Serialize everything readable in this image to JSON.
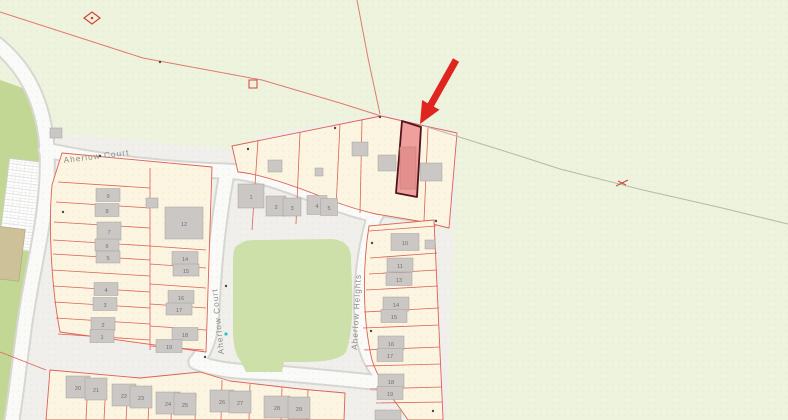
{
  "map": {
    "streets": {
      "aherlow_court_top": "Aherlow Court",
      "aherlow_court_side": "Aherlow Court",
      "aherlow_heights": "Aherlow Heights"
    },
    "plot_numbers": {
      "west_column": [
        {
          "n": "9",
          "x": 108,
          "y": 198,
          "w": 24,
          "h": 13
        },
        {
          "n": "8",
          "x": 107,
          "y": 213,
          "w": 24,
          "h": 13
        },
        {
          "n": "7",
          "x": 109,
          "y": 234,
          "w": 24,
          "h": 18
        },
        {
          "n": "6",
          "x": 107,
          "y": 248,
          "w": 24,
          "h": 12
        },
        {
          "n": "5",
          "x": 108,
          "y": 260,
          "w": 24,
          "h": 12
        },
        {
          "n": "4",
          "x": 106,
          "y": 292,
          "w": 24,
          "h": 13
        },
        {
          "n": "3",
          "x": 105,
          "y": 307,
          "w": 24,
          "h": 13
        },
        {
          "n": "2",
          "x": 103,
          "y": 327,
          "w": 24,
          "h": 13
        },
        {
          "n": "1",
          "x": 102,
          "y": 339,
          "w": 24,
          "h": 13
        }
      ],
      "east_column": [
        {
          "n": "12",
          "x": 184,
          "y": 226,
          "w": 38,
          "h": 32
        },
        {
          "n": "14",
          "x": 185,
          "y": 261,
          "w": 26,
          "h": 13
        },
        {
          "n": "15",
          "x": 186,
          "y": 273,
          "w": 26,
          "h": 12
        },
        {
          "n": "16",
          "x": 181,
          "y": 300,
          "w": 26,
          "h": 13
        },
        {
          "n": "17",
          "x": 179,
          "y": 312,
          "w": 26,
          "h": 12
        },
        {
          "n": "18",
          "x": 185,
          "y": 337,
          "w": 26,
          "h": 13
        },
        {
          "n": "19",
          "x": 169,
          "y": 349,
          "w": 26,
          "h": 13
        }
      ],
      "top_row": [
        {
          "n": "1",
          "x": 251,
          "y": 199,
          "w": 26,
          "h": 24
        },
        {
          "n": "2",
          "x": 276,
          "y": 209,
          "w": 20,
          "h": 20
        },
        {
          "n": "3",
          "x": 292,
          "y": 210,
          "w": 18,
          "h": 18
        },
        {
          "n": "4",
          "x": 317,
          "y": 208,
          "w": 20,
          "h": 19
        },
        {
          "n": "5",
          "x": 329,
          "y": 210,
          "w": 17,
          "h": 17
        }
      ],
      "heights_column": [
        {
          "n": "10",
          "x": 405,
          "y": 245,
          "w": 28,
          "h": 17
        },
        {
          "n": "11",
          "x": 400,
          "y": 268,
          "w": 26,
          "h": 14
        },
        {
          "n": "13",
          "x": 399,
          "y": 282,
          "w": 26,
          "h": 13
        },
        {
          "n": "14",
          "x": 396,
          "y": 307,
          "w": 26,
          "h": 14
        },
        {
          "n": "15",
          "x": 394,
          "y": 319,
          "w": 26,
          "h": 13
        },
        {
          "n": "16",
          "x": 391,
          "y": 346,
          "w": 26,
          "h": 14
        },
        {
          "n": "17",
          "x": 390,
          "y": 358,
          "w": 26,
          "h": 13
        },
        {
          "n": "18",
          "x": 391,
          "y": 384,
          "w": 26,
          "h": 14
        },
        {
          "n": "19",
          "x": 390,
          "y": 396,
          "w": 26,
          "h": 13
        }
      ],
      "bottom_row": [
        {
          "n": "20",
          "x": 78,
          "y": 390,
          "w": 24,
          "h": 22
        },
        {
          "n": "21",
          "x": 96,
          "y": 392,
          "w": 22,
          "h": 22
        },
        {
          "n": "22",
          "x": 124,
          "y": 398,
          "w": 24,
          "h": 22
        },
        {
          "n": "23",
          "x": 141,
          "y": 400,
          "w": 22,
          "h": 22
        },
        {
          "n": "24",
          "x": 168,
          "y": 406,
          "w": 24,
          "h": 22
        },
        {
          "n": "25",
          "x": 185,
          "y": 407,
          "w": 22,
          "h": 22
        },
        {
          "n": "26",
          "x": 222,
          "y": 404,
          "w": 24,
          "h": 22
        },
        {
          "n": "27",
          "x": 240,
          "y": 405,
          "w": 22,
          "h": 22
        },
        {
          "n": "28",
          "x": 277,
          "y": 410,
          "w": 26,
          "h": 22
        },
        {
          "n": "29",
          "x": 299,
          "y": 411,
          "w": 22,
          "h": 22
        }
      ]
    },
    "colors": {
      "field_green": "#eef3de",
      "edge_green": "#c3d795",
      "park_green": "#cde0a9",
      "parcel_cream": "#fcf5e1",
      "parcel_line_red": "#dd6055",
      "boundary_red": "#e07a6e",
      "boundary_gray": "#b8b8ab",
      "road_fill": "#fafaf8",
      "road_casing": "#d7d7d2",
      "estate_gray": "#f0efec",
      "building_gray": "#cac7c4",
      "building_edge": "#a5a29e",
      "highlight_fill": "#f0a09c",
      "highlight_border": "#521418",
      "arrow_red": "#e02420",
      "teal_marker": "#2ec0c8"
    }
  }
}
